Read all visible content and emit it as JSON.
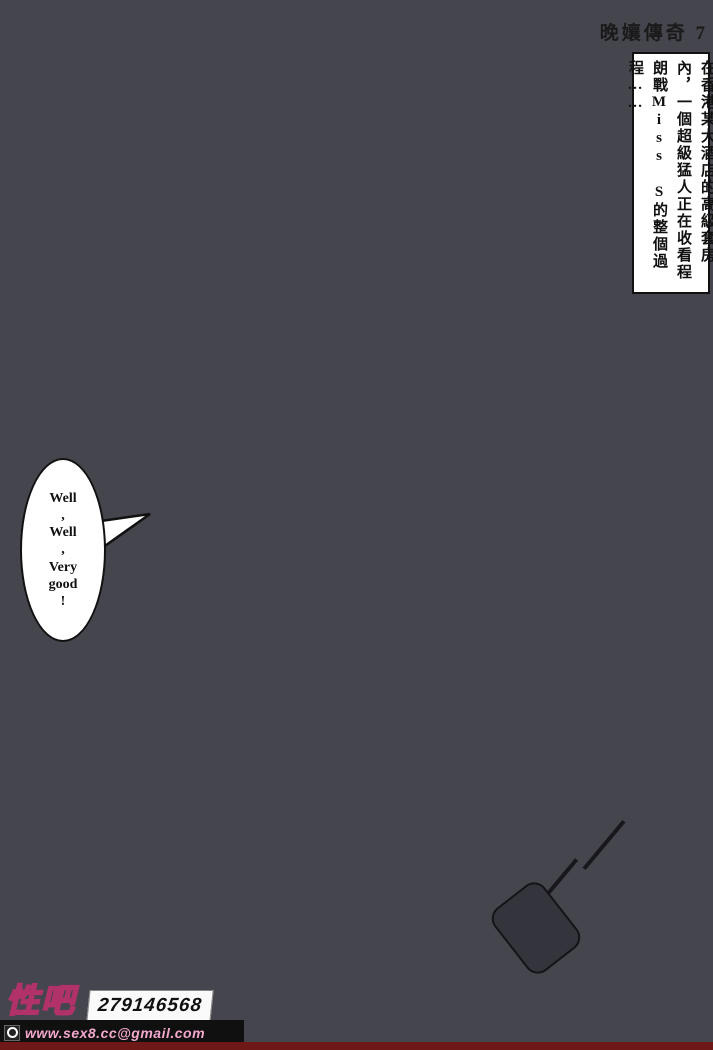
{
  "page": {
    "title": "晚孃傳奇 7"
  },
  "narration": {
    "text": "在香港某大酒店的高級套房內，一個超級猛人正在收看程朗戰Miss S的整個過程……"
  },
  "speech_bubble": {
    "text": "Well\n,\nWell\n,\nVery\ngood\n!"
  },
  "watermark": {
    "site_name": "性吧",
    "number": "279146568",
    "email": "www.sex8.cc@gmail.com"
  },
  "colors": {
    "floor": "#d97c50",
    "wall": "#d8e7ee",
    "window": "#a9c9b6",
    "curtain-pink": "#e7b0bc",
    "gold": "#dfc04e",
    "rug": "#9c8fc6",
    "rug-border": "#d9bc52",
    "wood": "#7c4a28",
    "canopy": "#f0e6bc",
    "blanket": "#c6d1ea",
    "tv-black": "#26262c",
    "sofa-black": "#2c2c32",
    "skin": "#d9a97e",
    "shorts": "#4a72c8",
    "accent-red": "#c04038",
    "plant-green": "#4e8a3c",
    "watermark-pink": "#f4a8cc",
    "ink": "#111111"
  }
}
